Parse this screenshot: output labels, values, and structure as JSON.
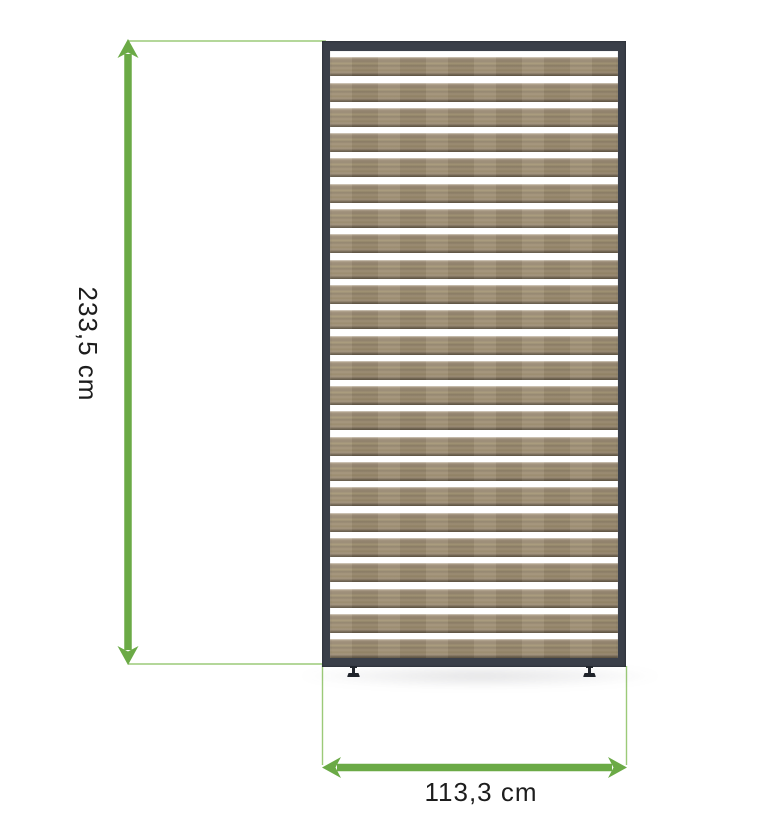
{
  "diagram": {
    "type": "product-dimension-diagram",
    "product": "slatted-privacy-screen-panel",
    "dimensions": {
      "height_label": "233,5 cm",
      "width_label": "113,3 cm"
    },
    "panel": {
      "slat_count": 24,
      "feet_count": 2
    },
    "colors": {
      "arrow_green": "#6BAA46",
      "extension_green": "#9CCA78",
      "frame_dark": "#3A3F49",
      "slat_wood": "#9C8C76",
      "label_text": "#1D1D1D",
      "background": "#FFFFFF"
    }
  }
}
